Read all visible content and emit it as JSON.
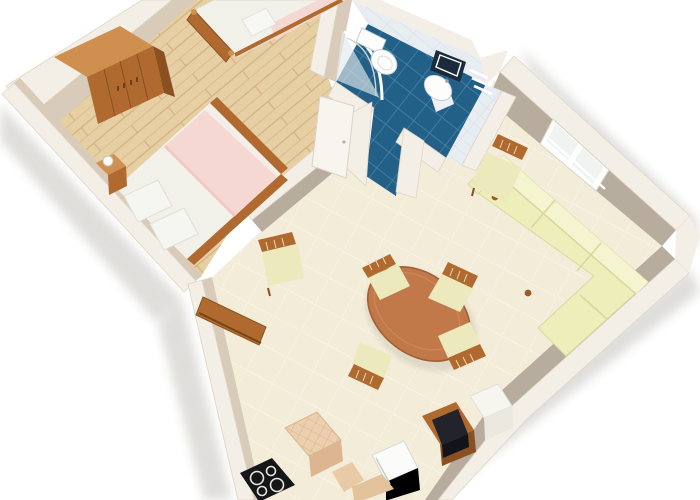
{
  "scene": {
    "title": "3D apartment floor plan render, top-down view",
    "view": "top-down 3d perspective, plan rotated diagonally, white background",
    "rooms": [
      {
        "name": "bedroom",
        "floor": "light oak parquet",
        "furniture": [
          "wardrobe",
          "single-bed",
          "double-bed",
          "nightstand-with-lamp",
          "bedroom-door-open"
        ]
      },
      {
        "name": "bathroom",
        "floor": "dark blue ceramic tile",
        "furniture": [
          "shower-enclosure",
          "toilet",
          "washbasin",
          "mirror",
          "towel-rail",
          "bathroom-door-open"
        ]
      },
      {
        "name": "living-dining-room",
        "floor": "cream ceramic tile",
        "furniture": [
          "corner-sofa",
          "dining-table-oval",
          "dining-chair x4",
          "side-chair-by-window",
          "side-chair-with-table",
          "tv-on-stand",
          "white-cabinet-column",
          "refrigerator",
          "kitchen-counter",
          "cooktop",
          "window-double-casement"
        ]
      }
    ]
  },
  "palette": {
    "outside": "#ffffff",
    "wallTop": "#f4efe6",
    "wallEdge": "#ddd5c6",
    "wallFaceWarm": "#d8cbba",
    "wallFaceGray": "#b7ac9d",
    "wallFaceDark": "#a89d8e",
    "parquet": "#e7cfa4",
    "parquetLine": "#d2b181",
    "tile": "#f3ecd8",
    "tileLine": "#fdfaf2",
    "bathFloor": "#226088",
    "bathFloorLine": "#4e85a8",
    "bathWall": "#e8edf2",
    "bathWallLine": "#d5dde7",
    "wood": "#b06a30",
    "woodLight": "#cf8f4e",
    "woodDark": "#8a5022",
    "linen": "#f2f1e9",
    "linenShadow": "#dddcd2",
    "blanketPink": "#f6d8d2",
    "blanketPinkDeep": "#f0c8c2",
    "sofa": "#eeeebb",
    "sofaLight": "#f5f4d0",
    "sofaShadow": "#d9d89d",
    "seatCream": "#ece9bd",
    "tableWood": "#c2794a",
    "tvBlack": "#23242b",
    "stoveBlack": "#161616",
    "counterTop": "#eccfae",
    "counterLine": "#d8b58e",
    "fridgeWhite": "#fbfbf9",
    "mirrorNavy": "#1b2b3c",
    "fixtureWhite": "#fdfdfc",
    "fixtureOutline": "#c6ccd2",
    "shadow": "#8f8a80"
  }
}
